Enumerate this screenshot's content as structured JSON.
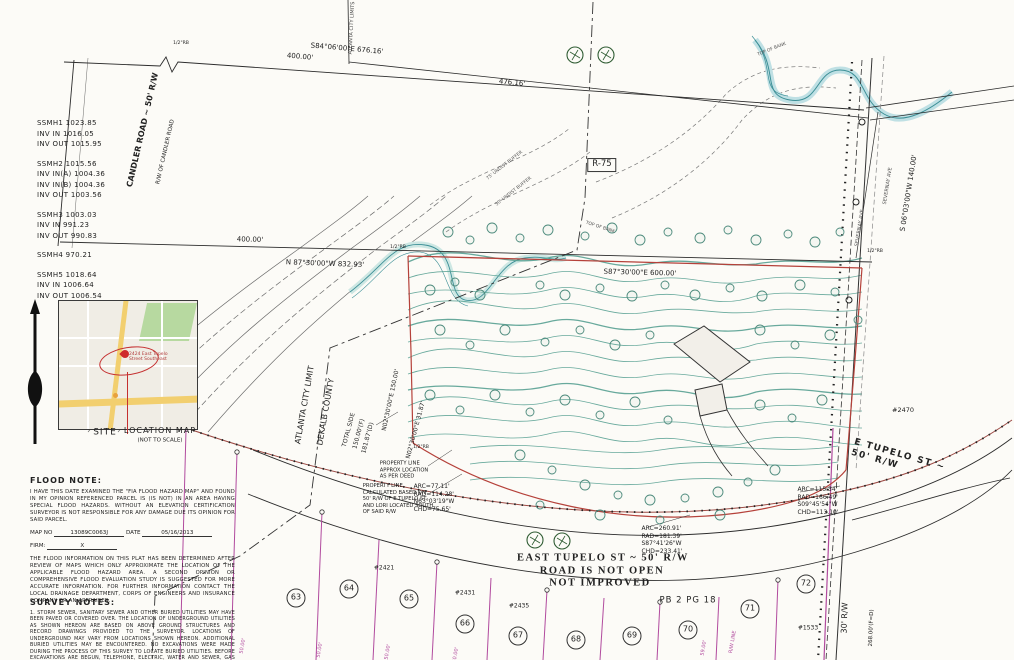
{
  "manhole_notes": [
    [
      "SSMH1 1023.85",
      "INV IN 1016.05",
      "INV OUT 1015.95"
    ],
    [
      "SSMH2 1015.56",
      "INV IN(A) 1004.36",
      "INV IN(B) 1004.36",
      "INV OUT 1003.56"
    ],
    [
      "SSMH3 1003.03",
      "INV IN 991.23",
      "INV OUT 990.83"
    ],
    [
      "SSMH4 970.21"
    ],
    [
      "SSMH5 1018.64",
      "INV IN 1006.64",
      "INV OUT 1006.54"
    ]
  ],
  "location_map": {
    "site_label": "SITE",
    "title": "LOCATION MAP",
    "subtitle": "(NOT TO SCALE)",
    "pin_note": "2424 East Tupelo\nStreet Southeast"
  },
  "flood_note": {
    "title": "FLOOD NOTE:",
    "para1": "I HAVE THIS DATE EXAMINED THE \"FIA FLOOD HAZARD MAP\" AND FOUND IN MY OPINION REFERENCED PARCEL IS (IS NOT) IN AN AREA HAVING SPECIAL FLOOD HAZARDS. WITHOUT AN ELEVATION CERTIFICATION SURVEYOR IS NOT RESPONSIBLE FOR ANY DAMAGE DUE ITS OPINION FOR SAID PARCEL.",
    "map_no_label": "MAP NO",
    "map_no": "13089C0063J",
    "date_label": "DATE",
    "date": "05/16/2013",
    "firm_label": "FIRM:",
    "firm": "X",
    "para2": "THE FLOOD INFORMATION ON THIS PLAT HAS BEEN DETERMINED AFTER REVIEW OF MAPS WHICH ONLY APPROXIMATE THE LOCATION OF THE APPLICABLE FLOOD HAZARD AREA. A SECOND OPINION OR COMPREHENSIVE FLOOD EVALUATION STUDY IS SUGGESTED FOR MORE ACCURATE INFORMATION. FOR FURTHER INFORMATION CONTACT THE LOCAL DRAINAGE DEPARTMENT, CORPS OF ENGINEERS AND INSURANCE COMPANY OR AN APPRAISER."
  },
  "survey_notes": {
    "title": "SURVEY NOTES:",
    "body": "1. STORM SEWER, SANITARY SEWER AND OTHER BURIED UTILITIES MAY HAVE BEEN PAVED OR COVERED OVER. THE LOCATION OF UNDERGROUND UTILITIES AS SHOWN HEREON ARE BASED ON ABOVE GROUND STRUCTURES AND RECORD DRAWINGS PROVIDED TO THE SURVEYOR. LOCATIONS OF UNDERGROUND MAY VARY FROM LOCATIONS SHOWN HEREON. ADDITIONAL BURIED UTILITIES MAY BE ENCOUNTERED. NO EXCAVATIONS WERE MADE DURING THE PROCESS OF THIS SURVEY TO LOCATE BURIED UTILITIES. BEFORE EXCAVATIONS ARE BEGUN, TELEPHONE, ELECTRIC, WATER AND SEWER, GAS COMPANIES SHALL BE CONTACTED FOR VERIFICATION OF UTILITY TYPE AND FOR FIELD LOCATIONS.\n2. THIS PLAT WAS PREPARED TO SHOW THE APPROXIMATE LOCATION OF THE"
  },
  "drawing": {
    "accent_colors": {
      "boundary_red": "#b5413a",
      "lot_magenta": "#b14a9e",
      "contour_teal": "#58a193"
    },
    "labels": [
      {
        "n": "candler-road-label",
        "t": "CANDLER ROAD ~ 50' R/W",
        "x": 143,
        "y": 130,
        "r": -77,
        "s": 8,
        "w": 700
      },
      {
        "n": "candler-rw-label",
        "t": "R/W OF CANDLER ROAD",
        "x": 166,
        "y": 152,
        "r": -77,
        "s": 5.5
      },
      {
        "n": "dim-400-top",
        "t": "400.00'",
        "x": 300,
        "y": 57,
        "r": 5,
        "s": 7
      },
      {
        "n": "bearing-s84",
        "t": "S84°06'00\"E  676.16'",
        "x": 347,
        "y": 49,
        "r": 5,
        "s": 7
      },
      {
        "n": "dim-476",
        "t": "476.16'",
        "x": 512,
        "y": 83,
        "r": 6,
        "s": 7
      },
      {
        "n": "city-limits-top",
        "t": "ATLANTA CITY LIMITS",
        "x": 352,
        "y": 28,
        "r": -87,
        "s": 5,
        "c": "#444"
      },
      {
        "n": "zoning-label",
        "t": "R-75",
        "x": 602,
        "y": 165,
        "s": 8.5,
        "box": true
      },
      {
        "n": "dim-400-mid",
        "t": "400.00'",
        "x": 250,
        "y": 240,
        "r": 1.5,
        "s": 7
      },
      {
        "n": "bearing-n87",
        "t": "N 87°30'00\"W  832.93'",
        "x": 325,
        "y": 264,
        "r": 2,
        "s": 7
      },
      {
        "n": "bearing-s87",
        "t": "S87°30'00\"E  600.00'",
        "x": 640,
        "y": 273,
        "r": 1.5,
        "s": 7
      },
      {
        "n": "bearing-s06",
        "t": "S 06°03'00\"W  140.00'",
        "x": 909,
        "y": 193,
        "r": -81,
        "s": 7
      },
      {
        "n": "severnay-ave-1",
        "t": "SEVERNAY AVE",
        "x": 860,
        "y": 228,
        "r": -81,
        "s": 5,
        "c": "#555"
      },
      {
        "n": "severnay-ave-2",
        "t": "SEVERNAY AVE",
        "x": 888,
        "y": 186,
        "r": -81,
        "s": 5,
        "c": "#555"
      },
      {
        "n": "buffer-label-1",
        "t": "75' UNDIST BUFFER",
        "x": 505,
        "y": 166,
        "r": -38,
        "s": 4.5,
        "c": "#555"
      },
      {
        "n": "buffer-label-2",
        "t": "50' UNDIST BUFFER",
        "x": 514,
        "y": 192,
        "r": -38,
        "s": 4.5,
        "c": "#555"
      },
      {
        "n": "top-of-bank-1",
        "t": "TOP OF BANK",
        "x": 772,
        "y": 50,
        "r": -22,
        "s": 4.5,
        "c": "#555"
      },
      {
        "n": "top-of-bank-2",
        "t": "TOP OF BANK",
        "x": 600,
        "y": 228,
        "r": 18,
        "s": 4.5,
        "c": "#555"
      },
      {
        "n": "atlanta-city-limit",
        "t": "ATLANTA CITY LIMIT",
        "x": 305,
        "y": 405,
        "r": -80,
        "s": 8
      },
      {
        "n": "dekalb-county",
        "t": "DEKALB COUNTY",
        "x": 326,
        "y": 412,
        "r": -80,
        "s": 8
      },
      {
        "n": "total-side",
        "t": "TOTAL SIDE",
        "x": 349,
        "y": 430,
        "r": -75,
        "s": 6
      },
      {
        "n": "total-side-f",
        "t": "150.00'(F)",
        "x": 359,
        "y": 434,
        "r": -75,
        "s": 6
      },
      {
        "n": "total-side-d",
        "t": "181.87'(D)",
        "x": 368,
        "y": 438,
        "r": -75,
        "s": 6
      },
      {
        "n": "bearing-n02-150",
        "t": "N02°30'00\"E 150.00'",
        "x": 391,
        "y": 400,
        "r": -78,
        "s": 6
      },
      {
        "n": "bearing-n02-31",
        "t": "N02°30'00\"E  31.87'",
        "x": 416,
        "y": 430,
        "r": -75,
        "s": 6
      },
      {
        "n": "property-line-note-1",
        "t": "PROPERTY LINE\nAPPROX LOCATION\nAS PER DEED",
        "x": 404,
        "y": 470,
        "s": 5.2
      },
      {
        "n": "property-line-note-2",
        "t": "PROPERTY LINE\nCALCULATED BASED ON\n50' R/W OF E TUPELO ST\nAND LORI LOCATED SOUTH\nOF SAID R/W",
        "x": 398,
        "y": 499,
        "s": 5.2
      },
      {
        "n": "curve-data-1",
        "t": "ARC=77.11'\nRAD=114.28'\nN63°03'19\"W\nCHD=75.65'",
        "x": 434,
        "y": 498,
        "s": 6
      },
      {
        "n": "curve-data-2",
        "t": "ARC=260.91'\nRAD=181.39'\nS87°41'26\"W\nCHD=233.41'",
        "x": 662,
        "y": 540,
        "s": 6
      },
      {
        "n": "curve-data-3",
        "t": "ARC=115.34'\nRAD=166.49'\nS09°45'54\"W\nCHD=113.10'",
        "x": 818,
        "y": 501,
        "s": 6
      },
      {
        "n": "east-tupelo-title",
        "t": "EAST TUPELO ST ~ 50' R/W",
        "x": 603,
        "y": 558,
        "s": 10.5,
        "w": 700,
        "f": "serif",
        "ls": 1.5
      },
      {
        "n": "road-not-open",
        "t": "ROAD IS NOT OPEN",
        "x": 602,
        "y": 571,
        "s": 10.5,
        "w": 700,
        "f": "serif",
        "ls": 1.5
      },
      {
        "n": "not-improved",
        "t": "NOT IMPROVED",
        "x": 600,
        "y": 583,
        "s": 10.5,
        "w": 700,
        "f": "serif",
        "ls": 1.5
      },
      {
        "n": "plat-book-ref",
        "t": "PB 2 PG 18",
        "x": 688,
        "y": 601,
        "s": 8.5,
        "ls": 1
      },
      {
        "n": "address-2421",
        "t": "#2421",
        "x": 384,
        "y": 568,
        "s": 6
      },
      {
        "n": "address-2431",
        "t": "#2431",
        "x": 465,
        "y": 593,
        "s": 6
      },
      {
        "n": "address-2435",
        "t": "#2435",
        "x": 519,
        "y": 606,
        "s": 6
      },
      {
        "n": "address-2470",
        "t": "#2470",
        "x": 903,
        "y": 410,
        "s": 6.5
      },
      {
        "n": "address-1533",
        "t": "#1533",
        "x": 808,
        "y": 628,
        "s": 6
      },
      {
        "n": "rw-30",
        "t": "30' R/W",
        "x": 845,
        "y": 618,
        "r": -88,
        "s": 8
      },
      {
        "n": "dim-268",
        "t": "268.00'(F=D)",
        "x": 872,
        "y": 628,
        "r": -88,
        "s": 5.5
      },
      {
        "n": "e-tupelo-label",
        "t": "E TUPELO ST ~ 50' R/W",
        "x": 905,
        "y": 463,
        "r": 16,
        "s": 9,
        "w": 700,
        "ls": 1.5
      },
      {
        "n": "rebar-1",
        "t": "1/2\"RB",
        "x": 398,
        "y": 248,
        "s": 4.6
      },
      {
        "n": "rebar-2",
        "t": "1/2\"RB",
        "x": 875,
        "y": 252,
        "s": 4.6
      },
      {
        "n": "rebar-3",
        "t": "1/2\"RB",
        "x": 421,
        "y": 448,
        "s": 4.6
      },
      {
        "n": "rebar-4",
        "t": "1/2\"RB",
        "x": 181,
        "y": 44,
        "s": 4.6
      },
      {
        "n": "lot-dim-1",
        "t": "50.00'",
        "x": 243,
        "y": 646,
        "r": -80,
        "s": 5,
        "c": "#b14a9e"
      },
      {
        "n": "lot-dim-2",
        "t": "50.00'",
        "x": 320,
        "y": 650,
        "r": -80,
        "s": 5,
        "c": "#b14a9e"
      },
      {
        "n": "lot-dim-3",
        "t": "50.00'",
        "x": 388,
        "y": 652,
        "r": -80,
        "s": 5,
        "c": "#b14a9e"
      },
      {
        "n": "lot-dim-4",
        "t": "50.00'",
        "x": 456,
        "y": 655,
        "r": -80,
        "s": 5,
        "c": "#b14a9e"
      },
      {
        "n": "lot-dim-5",
        "t": "59.00'",
        "x": 704,
        "y": 648,
        "r": -80,
        "s": 5,
        "c": "#b14a9e"
      },
      {
        "n": "rw-line-label",
        "t": "R/W LINE",
        "x": 733,
        "y": 642,
        "r": -80,
        "s": 5,
        "c": "#b14a9e"
      }
    ],
    "lots": [
      {
        "n": "63",
        "x": 296,
        "y": 598
      },
      {
        "n": "64",
        "x": 349,
        "y": 589
      },
      {
        "n": "65",
        "x": 409,
        "y": 599
      },
      {
        "n": "66",
        "x": 465,
        "y": 624
      },
      {
        "n": "67",
        "x": 518,
        "y": 636
      },
      {
        "n": "68",
        "x": 576,
        "y": 640
      },
      {
        "n": "69",
        "x": 632,
        "y": 636
      },
      {
        "n": "70",
        "x": 688,
        "y": 630
      },
      {
        "n": "71",
        "x": 750,
        "y": 609
      },
      {
        "n": "72",
        "x": 806,
        "y": 584
      }
    ],
    "trees": [
      [
        448,
        232,
        5
      ],
      [
        470,
        240,
        4
      ],
      [
        492,
        228,
        5
      ],
      [
        520,
        238,
        4
      ],
      [
        548,
        230,
        5
      ],
      [
        585,
        236,
        4
      ],
      [
        612,
        228,
        5
      ],
      [
        640,
        240,
        5
      ],
      [
        668,
        232,
        4
      ],
      [
        700,
        238,
        5
      ],
      [
        728,
        230,
        4
      ],
      [
        756,
        240,
        5
      ],
      [
        788,
        234,
        4
      ],
      [
        815,
        242,
        5
      ],
      [
        840,
        232,
        4
      ],
      [
        430,
        290,
        5
      ],
      [
        455,
        282,
        4
      ],
      [
        480,
        295,
        5
      ],
      [
        540,
        285,
        4
      ],
      [
        565,
        295,
        5
      ],
      [
        600,
        288,
        4
      ],
      [
        632,
        296,
        5
      ],
      [
        665,
        285,
        4
      ],
      [
        695,
        295,
        5
      ],
      [
        730,
        288,
        4
      ],
      [
        762,
        296,
        5
      ],
      [
        800,
        285,
        5
      ],
      [
        835,
        292,
        4
      ],
      [
        440,
        330,
        5
      ],
      [
        470,
        345,
        4
      ],
      [
        505,
        330,
        5
      ],
      [
        545,
        342,
        4
      ],
      [
        580,
        330,
        4
      ],
      [
        615,
        345,
        5
      ],
      [
        650,
        335,
        4
      ],
      [
        760,
        330,
        5
      ],
      [
        795,
        345,
        4
      ],
      [
        830,
        335,
        5
      ],
      [
        858,
        320,
        4
      ],
      [
        430,
        395,
        5
      ],
      [
        460,
        410,
        4
      ],
      [
        495,
        395,
        5
      ],
      [
        530,
        412,
        4
      ],
      [
        565,
        400,
        5
      ],
      [
        600,
        415,
        4
      ],
      [
        635,
        402,
        5
      ],
      [
        668,
        420,
        4
      ],
      [
        760,
        405,
        5
      ],
      [
        792,
        418,
        4
      ],
      [
        822,
        400,
        5
      ],
      [
        520,
        455,
        5
      ],
      [
        552,
        470,
        4
      ],
      [
        585,
        485,
        5
      ],
      [
        618,
        495,
        4
      ],
      [
        650,
        500,
        5
      ],
      [
        685,
        498,
        4
      ],
      [
        718,
        492,
        5
      ],
      [
        748,
        482,
        4
      ],
      [
        775,
        470,
        5
      ],
      [
        540,
        505,
        4
      ],
      [
        600,
        515,
        5
      ],
      [
        660,
        520,
        4
      ],
      [
        720,
        515,
        5
      ]
    ],
    "trees_hatched": [
      [
        575,
        55
      ],
      [
        606,
        55
      ],
      [
        535,
        540
      ],
      [
        562,
        541
      ]
    ]
  }
}
